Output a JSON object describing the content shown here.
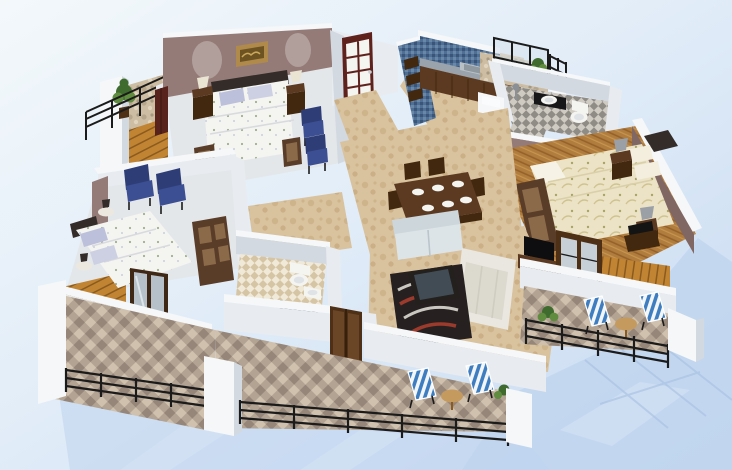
{
  "image_type": "3d-isometric-floor-plan-render",
  "scene_name": "3 BHK apartment isometric floor plan",
  "palette": {
    "bg-1": "#f2f7fa",
    "bg-2": "#dce9f6",
    "bg-3": "#c6d9f1",
    "shadow-1": "#bfd4ee",
    "shadow-2": "#d3e2f4",
    "wall-top": "#f5f7f9",
    "wall-light": "#e8ecf0",
    "wall-mid": "#d2d9e0",
    "wall-dark": "#bcc5cd",
    "mauve-1": "#947b77",
    "mauve-2": "#816763",
    "floor-gray": "#e4e7ea",
    "tan-1": "#d9c29e",
    "tan-2": "#cbb084",
    "tan-3": "#c1a274",
    "wood-1": "#b07d3e",
    "wood-2": "#96622a",
    "wood-3": "#c89450",
    "deck-1": "#c08433",
    "deck-2": "#8a5a1e",
    "chk-a": "#8f8b85",
    "chk-b": "#cfcac2",
    "chkb-a": "#d6c5a5",
    "chkb-b": "#f0e9d8",
    "terr-a": "#b2a392",
    "terr-b": "#cfc1ae",
    "terr-c": "#96867a",
    "kblue-1": "#4f6f94",
    "kblue-2": "#3a5578",
    "kblue-3": "#6d8cab",
    "cab-1": "#5c3a22",
    "cab-2": "#42280f",
    "counter": "#9aa2ab",
    "maroon": "#5e211c",
    "door-brown": "#4e3016",
    "navy-1": "#2e3d76",
    "navy-2": "#3c4f92",
    "white-soft": "#f4f4f1",
    "lav-1": "#bcc0da",
    "lav-2": "#ccd0e2",
    "cream-1": "#ece3c6",
    "cream-2": "#f6f3e6",
    "sofa-1": "#e9e7df",
    "sofa-2": "#dcd9cf",
    "sofa-blue-1": "#ccd6db",
    "sofa-blue-2": "#dde4e8",
    "rug-dark": "#262120",
    "rug-red": "#9c3a2c",
    "rug-white": "#e8e4de",
    "rug-brown-1": "#5a3d28",
    "rug-brown-2": "#8a6a48",
    "ink": "#1b1b1b",
    "green-1": "#3f6b2e",
    "green-2": "#5f8c3e",
    "stripe-blue": "#3d7dc0",
    "table-tan": "#c59a5e",
    "glass-1": "#d5e2ec",
    "steel": "#b9c1c7",
    "dark-wood": "#332c28"
  },
  "rooms": [
    {
      "id": "bedroom-1",
      "position": "top-left",
      "features": [
        "mauve accent wall",
        "framed wall art",
        "double bed with white floral duvet",
        "two lavender pillows",
        "two dark nightstands with cream lamps",
        "two navy armchairs",
        "two brown runner rugs",
        "dark red wardrobe",
        "wooden deck strip",
        "attached balcony with plant and black railing"
      ]
    },
    {
      "id": "bedroom-2",
      "position": "left-middle",
      "features": [
        "double bed with white duvet and lavender pillows",
        "two round side tables with lamps",
        "two navy armchairs",
        "brown block-pattern rug",
        "mirrored wardrobe",
        "wooden deck strip",
        "opens to terrace"
      ]
    },
    {
      "id": "master-bedroom",
      "position": "right",
      "features": [
        "wooden plank floor",
        "double bed with cream floral duvet",
        "two nightstands with gray lamps",
        "brown runner rug",
        "tv bench",
        "wooden deck strip",
        "tall glass door to living room"
      ]
    },
    {
      "id": "kitchen",
      "position": "top-center",
      "features": [
        "blue mosaic tiled walls",
        "L-shaped dark wood counter",
        "steel sink",
        "tall cabinet unit",
        "open shelf niches"
      ]
    },
    {
      "id": "utility-balcony",
      "position": "top-right-of-kitchen",
      "features": [
        "black framed glass partition",
        "potted plant",
        "black railing",
        "stone floor"
      ]
    },
    {
      "id": "bathroom-1",
      "position": "top-right",
      "features": [
        "gray diagonal checker floor",
        "wall shower",
        "black counter with white vessel basin",
        "white toilet",
        "half wall with towel"
      ]
    },
    {
      "id": "bathroom-2",
      "position": "center-left",
      "features": [
        "beige diagonal checker floor",
        "white toilet",
        "white washbasin",
        "dark glass shower area",
        "brown door to terrace"
      ]
    },
    {
      "id": "living-dining",
      "position": "center",
      "features": [
        "beige mottled marble floor",
        "six-seat dark wood dining table with white place settings",
        "light blue loveseat",
        "cream sofa",
        "dark coffee table",
        "black-white-red patterned rug",
        "flat tv with cabinet",
        "half wall to terrace"
      ]
    },
    {
      "id": "entry-foyer",
      "position": "top-center-left",
      "features": [
        "maroon entry door with white glass panes"
      ]
    },
    {
      "id": "right-balcony",
      "position": "bottom-right",
      "features": [
        "two blue striped deck chairs",
        "round wooden table",
        "black railing",
        "white parapet",
        "potted plant"
      ]
    },
    {
      "id": "terrace",
      "position": "bottom-left",
      "features": [
        "diagonal stone tile floor",
        "white parapet posts",
        "black metal railings",
        "two blue striped deck chairs",
        "round wooden table",
        "corner plants"
      ]
    }
  ],
  "environment": {
    "background": "pale blue gradient sky/ground",
    "shadows": "soft light-blue cast shadows toward bottom and right, with railing shadow lines"
  }
}
